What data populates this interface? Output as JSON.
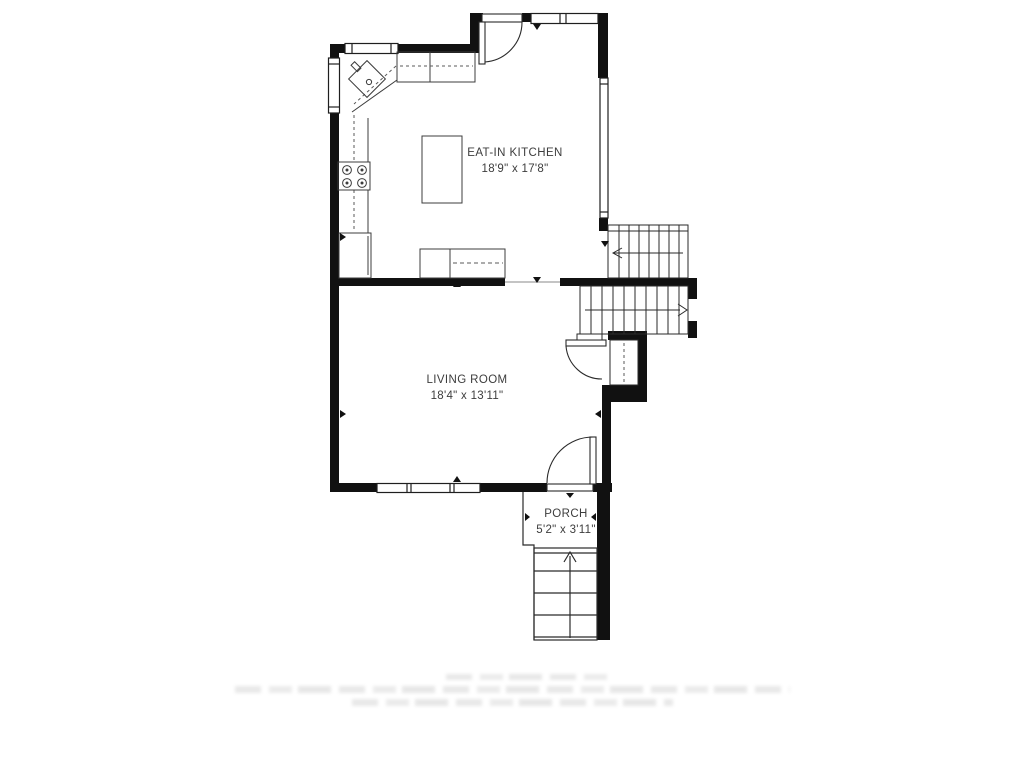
{
  "rooms": [
    {
      "id": "kitchen",
      "name": "EAT-IN KITCHEN",
      "dimensions": "18'9\" x 17'8\""
    },
    {
      "id": "living",
      "name": "LIVING ROOM",
      "dimensions": "18'4\" x 13'11\""
    },
    {
      "id": "porch",
      "name": "PORCH",
      "dimensions": "5'2\" x 3'11\""
    }
  ],
  "colors": {
    "wall": "#111111",
    "line": "#3c3c3c",
    "dashed_line": "#5a5a5a",
    "text": "#3d3d3d",
    "background": "#ffffff"
  }
}
